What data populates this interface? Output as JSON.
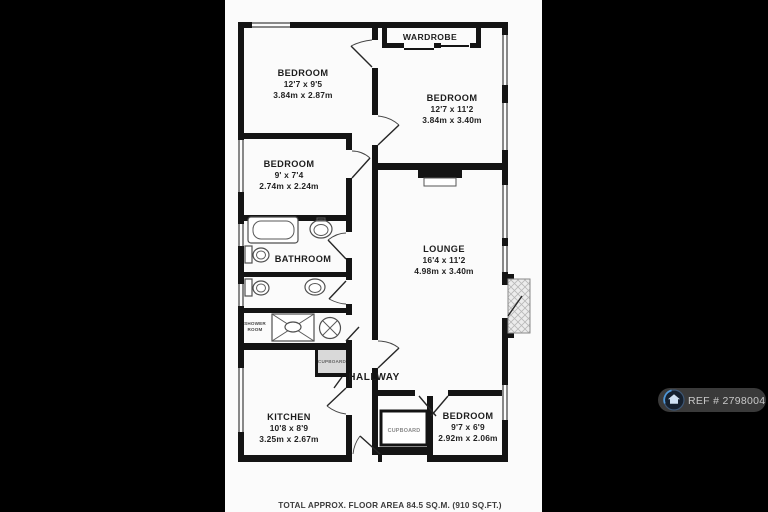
{
  "rooms": {
    "bedroom_top_left": {
      "name": "BEDROOM",
      "imperial": "12'7 x 9'5",
      "metric": "3.84m x 2.87m"
    },
    "wardrobe": {
      "name": "WARDROBE"
    },
    "bedroom_top_right": {
      "name": "BEDROOM",
      "imperial": "12'7 x 11'2",
      "metric": "3.84m x 3.40m"
    },
    "bedroom_mid_left": {
      "name": "BEDROOM",
      "imperial": "9' x 7'4",
      "metric": "2.74m x 2.24m"
    },
    "bathroom": {
      "name": "BATHROOM"
    },
    "lounge": {
      "name": "LOUNGE",
      "imperial": "16'4 x 11'2",
      "metric": "4.98m x 3.40m"
    },
    "shower_room": {
      "name_line1": "SHOWER",
      "name_line2": "ROOM"
    },
    "hall_cupboard": {
      "name": "CUPBOARD"
    },
    "hallway": {
      "name": "HALLWAY"
    },
    "kitchen": {
      "name": "KITCHEN",
      "imperial": "10'8 x 8'9",
      "metric": "3.25m x 2.67m"
    },
    "bottom_cupboard": {
      "name": "CUPBOARD"
    },
    "bedroom_bottom_right": {
      "name": "BEDROOM",
      "imperial": "9'7 x 6'9",
      "metric": "2.92m x 2.06m"
    }
  },
  "footer": {
    "total_area": "TOTAL APPROX. FLOOR AREA 84.5 SQ.M. (910 SQ.FT.)"
  },
  "badge": {
    "ref_label": "REF # 2798004"
  },
  "colors": {
    "letterbox": "#000000",
    "paper": "#fbfbfb",
    "wall": "#141414",
    "badge_bg": "#3c3c3c",
    "badge_ring_blue": "#4f97d8"
  }
}
